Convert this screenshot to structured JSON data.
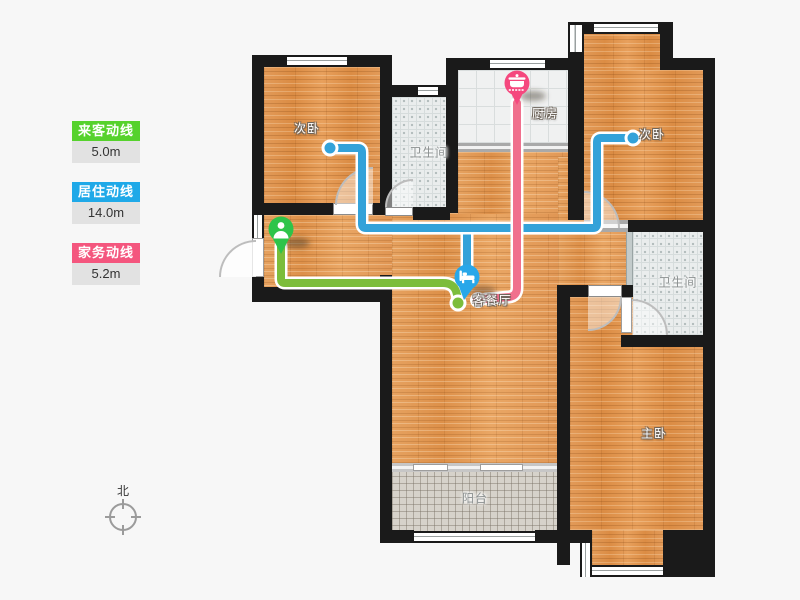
{
  "colors": {
    "legend_green": "#56d22d",
    "legend_blue": "#1fa9e8",
    "legend_pink": "#f4567e",
    "line_green": "#7cbd3b",
    "line_blue": "#33a2d9",
    "line_pink": "#f0708d",
    "pin_green": "#2ec44a",
    "pin_blue": "#28a7e9",
    "pin_pink": "#f5487e"
  },
  "legend": {
    "items": [
      {
        "label": "来客动线",
        "value": "5.0m"
      },
      {
        "label": "居住动线",
        "value": "14.0m"
      },
      {
        "label": "家务动线",
        "value": "5.2m"
      }
    ]
  },
  "rooms": {
    "bedroom_left": "次卧",
    "bedroom_right": "次卧",
    "bathroom_top": "卫生间",
    "bathroom_right": "卫生间",
    "kitchen": "厨房",
    "living_dining": "客餐厅",
    "master_bedroom": "主卧",
    "balcony": "阳台"
  },
  "compass": {
    "north": "北"
  }
}
